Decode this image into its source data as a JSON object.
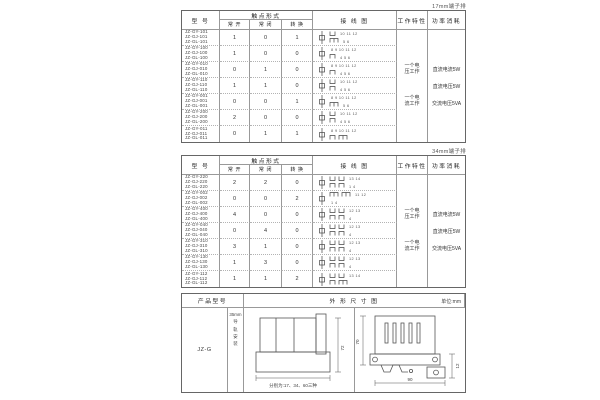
{
  "colors": {
    "ink": "#333333",
    "border": "#999999",
    "outer_border": "#666666"
  },
  "t1": {
    "corner_label": "17mm端子排",
    "headers": {
      "model": "型 号",
      "contact": "触点形式",
      "no": "常 开",
      "nc": "常 闭",
      "co": "转 换",
      "wiring": "接 线 图",
      "work": "工作特性",
      "power": "功率消耗"
    },
    "work_items": [
      [
        "一个电",
        "压工作"
      ],
      [
        "一个电",
        "流工作"
      ]
    ],
    "power_items": [
      "直流电流5W",
      "直流电压5W",
      "交流电压5VA"
    ],
    "rows": [
      {
        "models": [
          "JZ-GY-101",
          "JZ-GJ-101",
          "JZ-GL-101"
        ],
        "no": "1",
        "nc": "0",
        "co": "1",
        "diag": {
          "ts": "u",
          "tn": "10 11 12",
          "bs": "t",
          "bn": "5 6"
        }
      },
      {
        "models": [
          "JZ-GY-100",
          "JZ-GJ-100",
          "JZ-GL-100"
        ],
        "no": "1",
        "nc": "0",
        "co": "0",
        "diag": {
          "ts": "",
          "tn": "8 9 10 11 12",
          "bs": "n",
          "bn": "4 5 6"
        }
      },
      {
        "models": [
          "JZ-GY-010",
          "JZ-GJ-010",
          "JZ-GL-010"
        ],
        "no": "0",
        "nc": "1",
        "co": "0",
        "diag": {
          "ts": "",
          "tn": "8 9 10 11 12",
          "bs": "n",
          "bn": "4 5 6"
        }
      },
      {
        "models": [
          "JZ-GY-110",
          "JZ-GJ-110",
          "JZ-GL-110"
        ],
        "no": "1",
        "nc": "1",
        "co": "0",
        "diag": {
          "ts": "u",
          "tn": "10 11 12",
          "bs": "n",
          "bn": "4 5 6"
        }
      },
      {
        "models": [
          "JZ-GY-001",
          "JZ-GJ-001",
          "JZ-GL-001"
        ],
        "no": "0",
        "nc": "0",
        "co": "1",
        "diag": {
          "ts": "",
          "tn": "8 9 10 11 12",
          "bs": "t",
          "bn": "5 6"
        }
      },
      {
        "models": [
          "JZ-GY-200",
          "JZ-GJ-200",
          "JZ-GL-200"
        ],
        "no": "2",
        "nc": "0",
        "co": "0",
        "diag": {
          "ts": "u",
          "tn": "10 11 12",
          "bs": "n",
          "bn": "4 5 6"
        }
      },
      {
        "models": [
          "JZ-GY-011",
          "JZ-GJ-011",
          "JZ-GL-011"
        ],
        "no": "0",
        "nc": "1",
        "co": "1",
        "diag": {
          "ts": "",
          "tn": "8 9 10 11 12",
          "bs": "n t",
          "bn": ""
        }
      }
    ]
  },
  "t2": {
    "corner_label": "34mm端子排",
    "headers": {
      "model": "型 号",
      "contact": "触点形式",
      "no": "常 开",
      "nc": "常 闭",
      "co": "转 换",
      "wiring": "接 线 图",
      "work": "工作特性",
      "power": "功率消耗"
    },
    "work_items": [
      [
        "一个电",
        "压工作"
      ],
      [
        "一个电",
        "流工作"
      ]
    ],
    "power_items": [
      "直流电流5W",
      "直流电压5W",
      "交流电压5VA"
    ],
    "rows": [
      {
        "models": [
          "JZ-GY-220",
          "JZ-GJ-220",
          "JZ-GL-220"
        ],
        "no": "2",
        "nc": "2",
        "co": "0",
        "diag": {
          "ts": "u u",
          "tn": "13 14",
          "bs": "n n",
          "bn": "1 4"
        }
      },
      {
        "models": [
          "JZ-GY-002",
          "JZ-GJ-002",
          "JZ-GL-002"
        ],
        "no": "0",
        "nc": "0",
        "co": "2",
        "diag": {
          "ts": "t t",
          "tn": "11 12",
          "bs": "",
          "bn": "1 4"
        }
      },
      {
        "models": [
          "JZ-GY-400",
          "JZ-GJ-400",
          "JZ-GL-400"
        ],
        "no": "4",
        "nc": "0",
        "co": "0",
        "diag": {
          "ts": "u u",
          "tn": "12 13",
          "bs": "n n",
          "bn": "4"
        }
      },
      {
        "models": [
          "JZ-GY-040",
          "JZ-GJ-040",
          "JZ-GL-040"
        ],
        "no": "0",
        "nc": "4",
        "co": "0",
        "diag": {
          "ts": "u u",
          "tn": "12 13",
          "bs": "n n",
          "bn": "4"
        }
      },
      {
        "models": [
          "JZ-GY-310",
          "JZ-GJ-310",
          "JZ-GL-310"
        ],
        "no": "3",
        "nc": "1",
        "co": "0",
        "diag": {
          "ts": "u u",
          "tn": "12 13",
          "bs": "n n",
          "bn": "4"
        }
      },
      {
        "models": [
          "JZ-GY-130",
          "JZ-GJ-130",
          "JZ-GL-130"
        ],
        "no": "1",
        "nc": "3",
        "co": "0",
        "diag": {
          "ts": "u u",
          "tn": "12 13",
          "bs": "n n",
          "bn": "4"
        }
      },
      {
        "models": [
          "JZ-GY-112",
          "JZ-GJ-112",
          "JZ-GL-112"
        ],
        "no": "1",
        "nc": "1",
        "co": "2",
        "diag": {
          "ts": "u u",
          "tn": "13 14",
          "bs": "n t",
          "bn": ""
        }
      }
    ]
  },
  "t3": {
    "headers": {
      "product": "产品型号",
      "outline": "外 形 尺 寸 图",
      "unit": "单位:mm"
    },
    "model": "JZ-G",
    "mount": [
      "35mm",
      "导",
      "轨",
      "安",
      "装"
    ],
    "note": "分别为:17、34、60三种",
    "dims": {
      "front_height": "72",
      "side_height": "70",
      "side_width": "90",
      "side_depth": "12"
    }
  }
}
